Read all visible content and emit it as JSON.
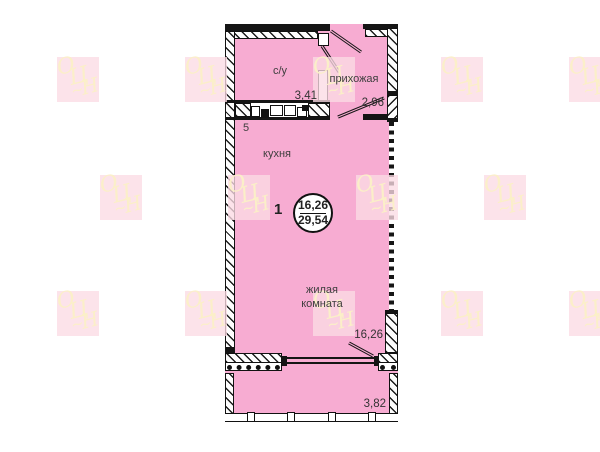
{
  "floor_plan": {
    "bathroom": {
      "label": "с/у",
      "area": "3,41"
    },
    "hallway": {
      "label": "прихожая",
      "area": "2,96"
    },
    "kitchen": {
      "label": "кухня",
      "number": "5"
    },
    "living_room": {
      "label": "жилая комната",
      "area": "16,26"
    },
    "balcony": {
      "area": "3,82"
    },
    "apartment": {
      "index": "1",
      "living_area": "16,26",
      "total_area": "29,54"
    }
  },
  "watermark": {
    "text": "ОЦН",
    "letters": [
      "О",
      "Ц",
      "Н"
    ],
    "flourish": "~"
  },
  "colors": {
    "room_fill": "#F7ACD2",
    "wall": "#151515",
    "watermark_bg": "#FBDBE4",
    "watermark_text": "#FBEFC7"
  }
}
